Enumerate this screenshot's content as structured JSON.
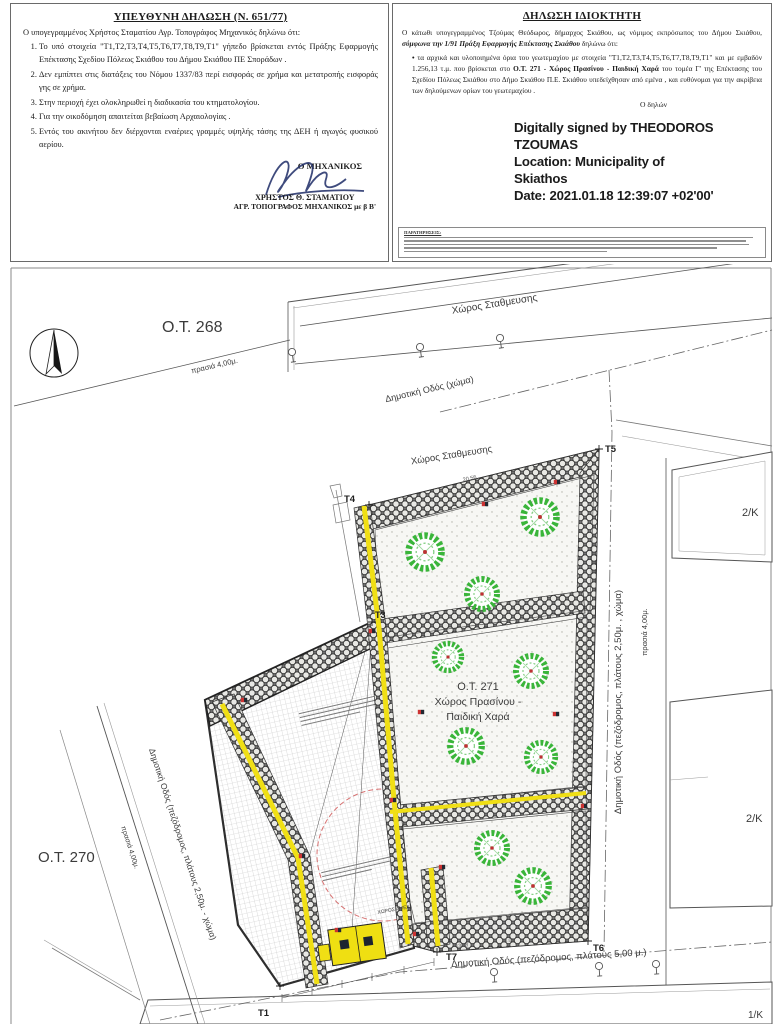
{
  "engineer_declaration": {
    "title": "ΥΠΕΥΘΥΝΗ ΔΗΛΩΣΗ (Ν. 651/77)",
    "intro": "Ο υπογεγραμμένος Χρήστος Σταματίου Αγρ. Τοπογράφος Μηχανικός δηλώνω ότι:",
    "items": [
      "Το υπό στοιχεία \"Τ1,Τ2,Τ3,Τ4,Τ5,Τ6,Τ7,Τ8,Τ9,Τ1\" γήπεδο βρίσκεται εντός Πράξης Εφαρμογής Επέκτασης Σχεδίου Πόλεως Σκιάθου του Δήμου Σκιάθου ΠΕ Σποράδων .",
      "Δεν εμπίπτει στις διατάξεις του Νόμου 1337/83 περί εισφοράς σε χρήμα και μετατροπής εισφοράς γης σε χρήμα.",
      "Στην περιοχή έχει ολοκληρωθεί η διαδικασία του κτηματολογίου.",
      "Για την οικοδόμηση απαιτείται βεβαίωση Αρχαιολογίας .",
      "Εντός του ακινήτου δεν διέρχονται εναέριες γραμμές υψηλής τάσης της ΔΕΗ ή αγωγός φυσικού αερίου."
    ],
    "signature_role": "Ο ΜΗΧΑΝΙΚΟΣ",
    "signer_name": "ΧΡΗΣΤΟΣ Θ. ΣΤΑΜΑΤΙΟΥ",
    "signer_title": "ΑΓΡ. ΤΟΠΟΓΡΑΦΟΣ ΜΗΧΑΝΙΚΟΣ με β Β'"
  },
  "owner_declaration": {
    "title": "ΔΗΛΩΣΗ ΙΔΙΟΚΤΗΤΗ",
    "intro_1": "Ο κάτωθι υπογεγραμμένος Τζούμας Θεόδωρος, δήμαρχος Σκιάθου, ως νόμιμος εκπρόσωπος του Δήμου Σκιάθου,",
    "intro_emph": "σύμφωνα την 1/91 Πράξη Εφαρμογής Επέκτασης Σκιάθου",
    "intro_2": "δηλώνω ότι:",
    "bullet_marker": "•",
    "bullet_1": "τα αρχικά και υλοποιημένα όρια του γεωτεμαχίου με στοιχεία \"Τ1,Τ2,Τ3,Τ4,Τ5,Τ6,Τ7,Τ8,Τ9,Τ1\" και με εμβαδόν 1.256,13 τ.μ. που βρίσκεται στο",
    "bullet_emph": "Ο.Τ. 271 - Χώρος Πρασίνου - Παιδική Χαρά",
    "bullet_2": "του τομέα Γ' της Επέκτασης του Σχεδίου Πόλεως Σκιάθου στο Δήμο Σκιάθου Π.Ε. Σκιάθου υπεδείχθησαν από εμένα , και ευθύνομαι για την ακρίβεια των δηλούμενων ορίων του γεωτεμαχίου .",
    "declarant": "Ο δηλών",
    "digital_signature": {
      "lines": [
        "Digitally signed by THEODOROS",
        "TZOUMAS",
        "Location: Municipality of",
        "Skiathos",
        "Date: 2021.01.18 12:39:07 +02'00'"
      ]
    },
    "notes_title": "ΠΑΡΑΤΗΡΗΣΕΙΣ:"
  },
  "plan": {
    "blocks": {
      "ot268": "Ο.Τ. 268",
      "ot270": "Ο.Τ. 270",
      "ot271": [
        "Ο.Τ.  271",
        "Χώρος Πρασίνου -",
        "Παιδική Χαρά"
      ]
    },
    "labels": {
      "parking_top": "Χώρος Σταθμευσης",
      "parking_inner": "Χώρος Σταθμευσης",
      "road_top": "Δημοτική Οδός (χώμα)",
      "road_right": "Δημοτική Οδός (πεζόδρομος, πλάτους 2,50μ. , χώμα)",
      "road_left": "Δημοτική Οδός (πεζόδρομος, πλάτους 2,50μ. - χώμα)",
      "road_bottom": "Δημοτική Οδός (πεζόδρομος, πλάτους 5,00 μ.)",
      "prasia_top": "πρασιά 4,00μ.",
      "prasia_right": "πρασιά 4,00μ.",
      "prasia_left": "πρασιά 4,00μ.",
      "amea": "ΧΩΡΟΣ ΑΜΕΑ"
    },
    "buildings": {
      "upper_right": "2/Κ",
      "lower_right": "2/Κ",
      "bottom": "1/Κ"
    },
    "points": {
      "t1": "T1",
      "t3": "T3",
      "t4": "T4",
      "t5": "T5",
      "t6": "T6",
      "t7": "T7"
    },
    "dimensions": {
      "top_edge": "20.56",
      "bottom_a": "13.48",
      "bottom_b": "13.04"
    },
    "colors": {
      "path_yellow": "#f0df15",
      "tree_green": "#3ab53a",
      "marker_red": "#cc3333",
      "hatch_gray": "#6e6e6e"
    }
  }
}
